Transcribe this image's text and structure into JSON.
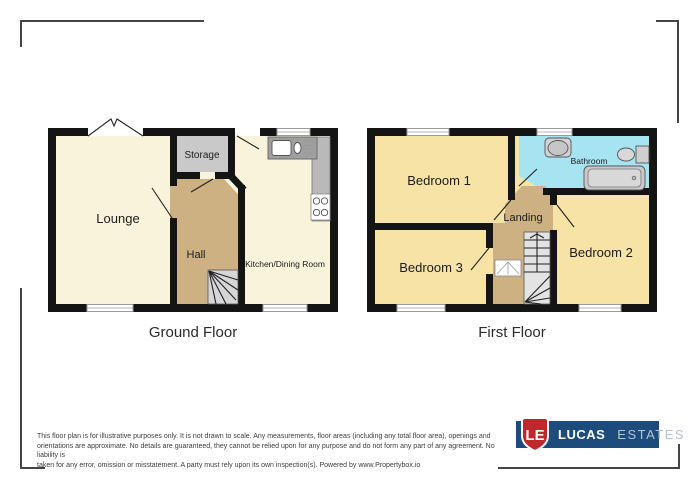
{
  "colors": {
    "wall": "#141414",
    "cream": "#faf3db",
    "yellow": "#f6e3a5",
    "tan": "#cdb183",
    "storage_gray": "#c9c9c9",
    "bathroom_blue": "#a6e4f2",
    "counter_gray": "#b9b9b9",
    "bracket_gray": "#454545",
    "logo_blue": "#1d4c7c",
    "logo_red": "#c0272d",
    "logo_estates": "#b6c3d4"
  },
  "plans": {
    "ground": {
      "title": "Ground Floor",
      "rooms": {
        "lounge": "Lounge",
        "storage": "Storage",
        "hall": "Hall",
        "kitchen": "Kitchen/Dining Room"
      }
    },
    "first": {
      "title": "First Floor",
      "rooms": {
        "bedroom1": "Bedroom 1",
        "bathroom": "Bathroom",
        "landing": "Landing",
        "bedroom2": "Bedroom 2",
        "bedroom3": "Bedroom 3"
      }
    }
  },
  "icons": {
    "kitchen_sink": "kitchen-sink-icon",
    "hob": "hob-icon",
    "stairs": "stairs-icon",
    "basin": "basin-icon",
    "toilet": "toilet-icon",
    "bathtub": "bathtub-icon",
    "window": "window-icon",
    "door": "door-icon"
  },
  "disclaimer": {
    "lines": [
      "This floor plan is for illustrative purposes only. It is not drawn to scale. Any measurements, floor areas (including any total floor area), openings and",
      "orientations are approximate. No details are guaranteed, they cannot be relied upon for any purpose and do not form any part of any agreement. No liability is",
      "taken for any error, omission or misstatement. A party must rely upon its own inspection(s). Powered by www.Propertybox.io"
    ]
  },
  "logo": {
    "initials": "LE",
    "name": "LUCAS",
    "suffix": "ESTATES"
  }
}
